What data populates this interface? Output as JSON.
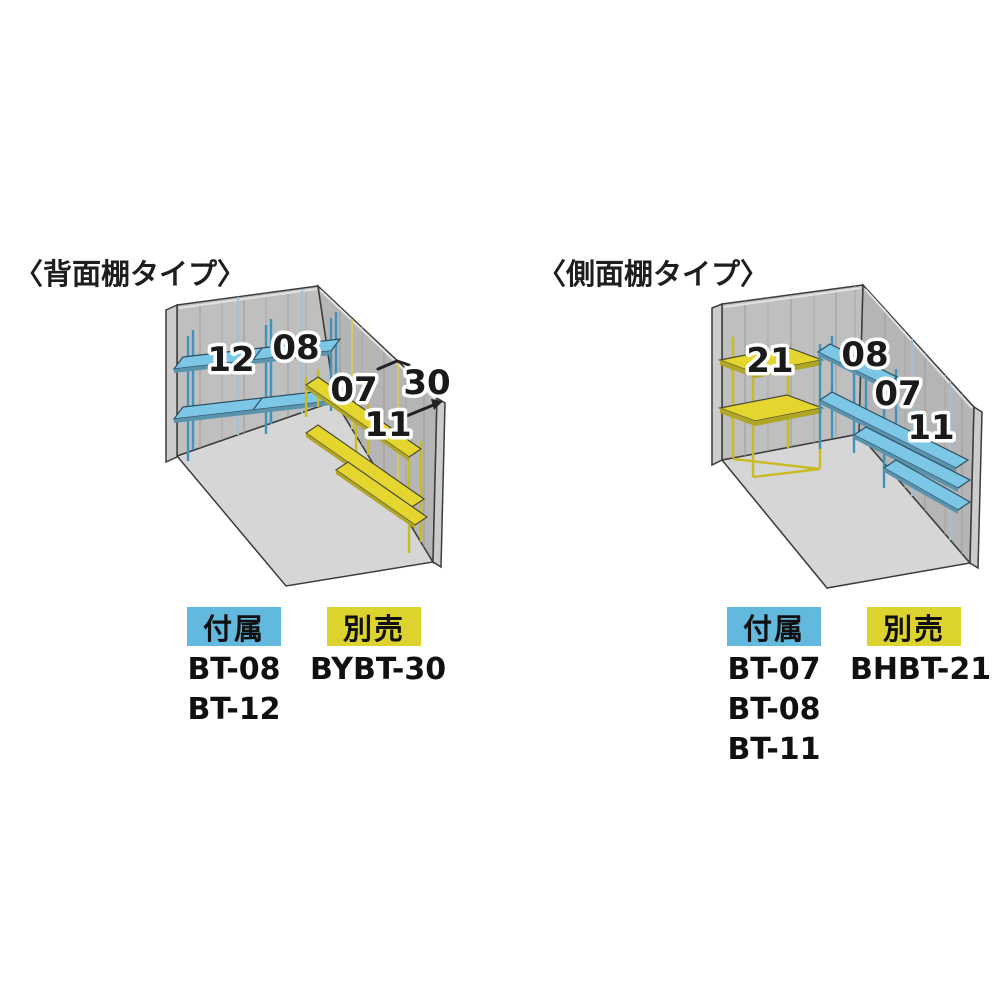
{
  "diagrams": {
    "left": {
      "title": "〈背面棚タイプ〉",
      "labels": {
        "back_shelf_a": "12",
        "back_shelf_b": "08",
        "side_shelf_a": "07",
        "side_shelf_b": "11",
        "depth_note": "30"
      },
      "legend": {
        "included_label": "付属",
        "included_items": [
          "BT-08",
          "BT-12"
        ],
        "separate_label": "別売",
        "separate_items": [
          "BYBT-30"
        ]
      }
    },
    "right": {
      "title": "〈側面棚タイプ〉",
      "labels": {
        "back_unit": "21",
        "side_shelf_a": "08",
        "side_shelf_b": "07",
        "side_shelf_c": "11"
      },
      "legend": {
        "included_label": "付属",
        "included_items": [
          "BT-07",
          "BT-08",
          "BT-11"
        ],
        "separate_label": "別売",
        "separate_items": [
          "BHBT-21"
        ]
      }
    }
  },
  "colors": {
    "legend_blue": "#63b9dd",
    "legend_yellow": "#ddd32e",
    "shelf_blue": "#7cc6e6",
    "shelf_blue_edge": "#5a93ad",
    "shelf_yellow": "#e4d62f",
    "shelf_yellow_edge": "#b0a524",
    "wall_back": "#bfbfbf",
    "wall_side": "#b5b5b5",
    "wall_strip": "#cccccc",
    "floor": "#d6d6d6",
    "outline": "#3c3c3c"
  }
}
